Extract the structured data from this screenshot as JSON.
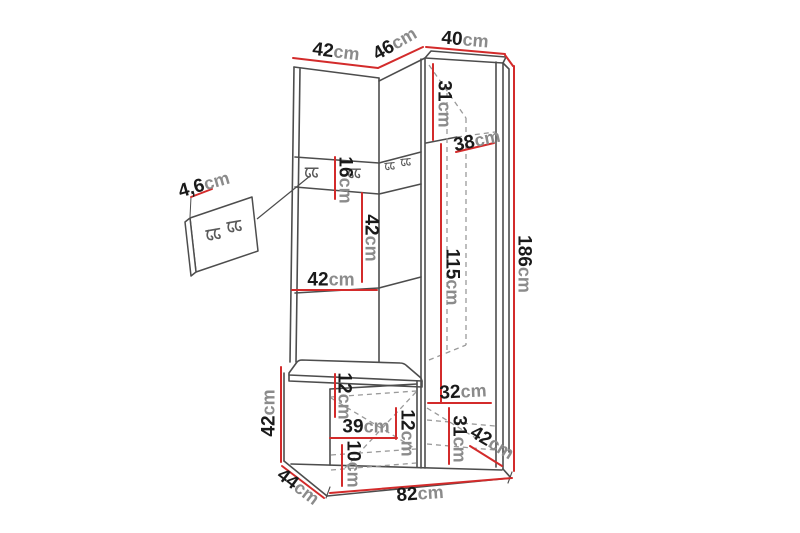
{
  "image": {
    "description": "Dimension line-drawing of a corner hallway furniture set (wardrobe, hook panel, bench) with a detail callout of the hook board",
    "background_color": "#ffffff"
  },
  "colors": {
    "outline": "#4d4d4d",
    "dashed": "#9a9a9a",
    "dimension_line": "#d32b2b",
    "value_text": "#1a1a1a",
    "unit_text": "#8b8b8b"
  },
  "dims": {
    "top_width_left": {
      "num": "42",
      "unit": "cm"
    },
    "top_width_middle": {
      "num": "46",
      "unit": "cm"
    },
    "top_width_right": {
      "num": "40",
      "unit": "cm"
    },
    "upper_cabinet_section_height": {
      "num": "31",
      "unit": "cm"
    },
    "upper_cabinet_width": {
      "num": "38",
      "unit": "cm"
    },
    "hook_panel_height": {
      "num": "16",
      "unit": "cm"
    },
    "middle_section_height": {
      "num": "42",
      "unit": "cm"
    },
    "middle_section_width": {
      "num": "42",
      "unit": "cm"
    },
    "cabinet_interior_height": {
      "num": "115",
      "unit": "cm"
    },
    "total_height": {
      "num": "186",
      "unit": "cm"
    },
    "hook_board_thickness": {
      "num": "4,6",
      "unit": "cm"
    },
    "bench_height": {
      "num": "42",
      "unit": "cm"
    },
    "seat_thickness": {
      "num": "12",
      "unit": "cm"
    },
    "bench_interior_width": {
      "num": "39",
      "unit": "cm"
    },
    "bench_shelf_height": {
      "num": "12",
      "unit": "cm"
    },
    "bench_bottom_height": {
      "num": "10",
      "unit": "cm"
    },
    "lower_cabinet_width": {
      "num": "32",
      "unit": "cm"
    },
    "lower_cabinet_height": {
      "num": "31",
      "unit": "cm"
    },
    "cabinet_depth": {
      "num": "42",
      "unit": "cm"
    },
    "bench_depth": {
      "num": "44",
      "unit": "cm"
    },
    "total_width": {
      "num": "82",
      "unit": "cm"
    }
  }
}
